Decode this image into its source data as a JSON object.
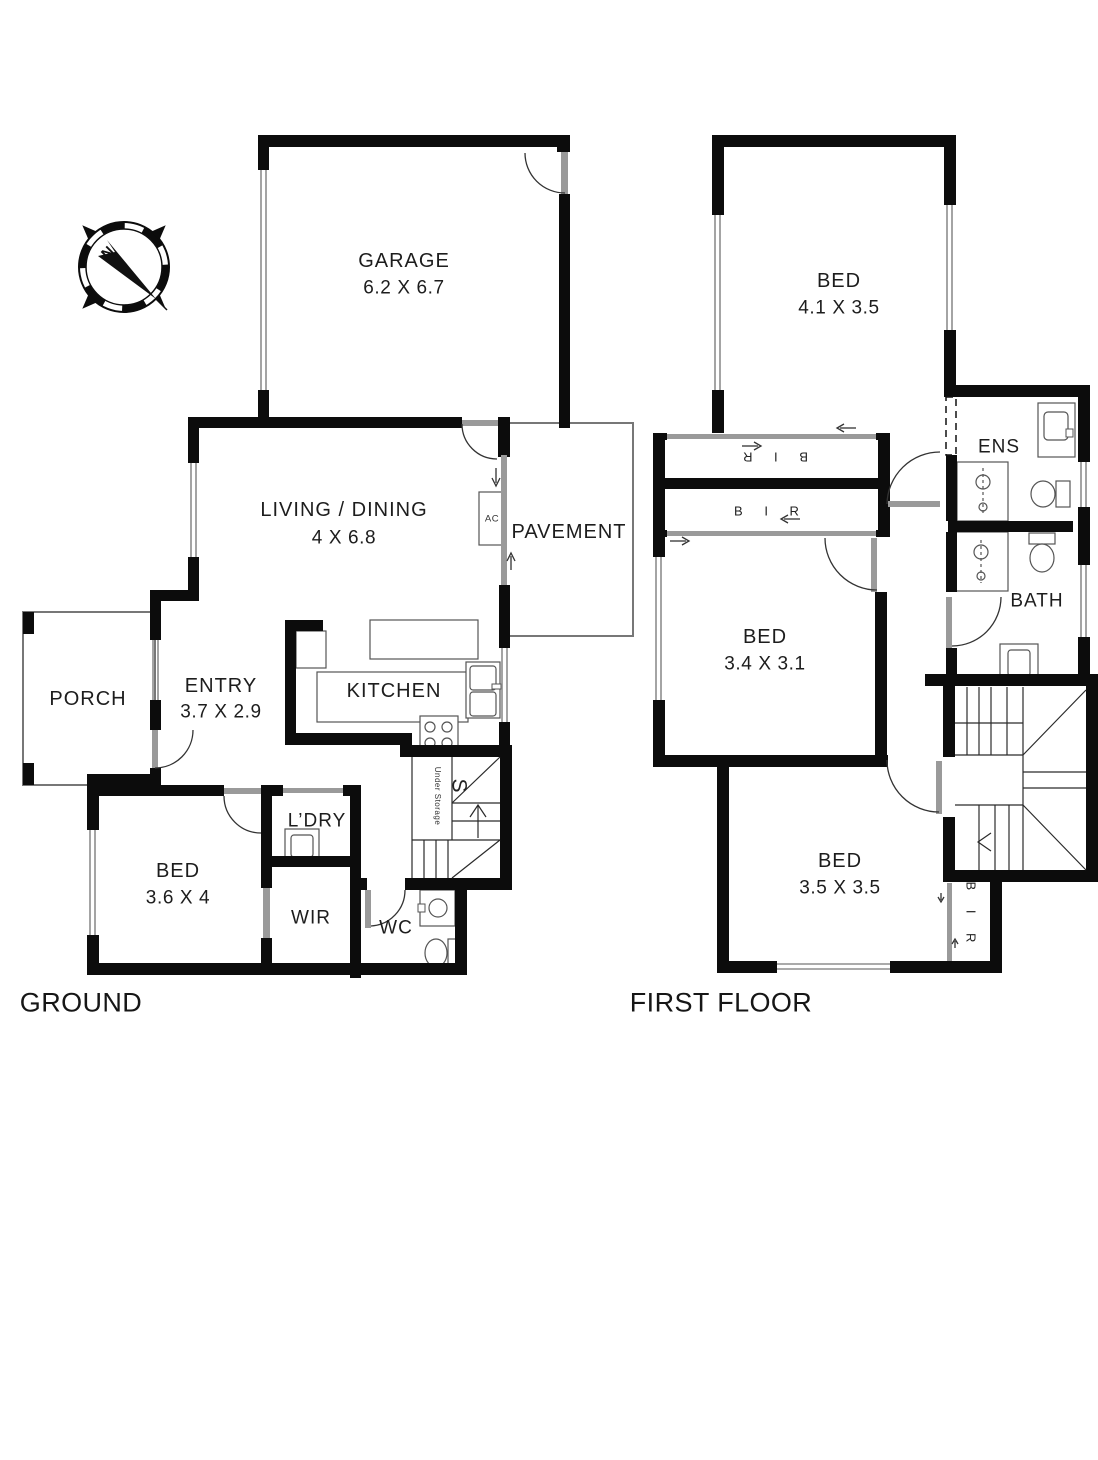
{
  "ground_floor": {
    "caption": "GROUND",
    "garage": {
      "name": "GARAGE",
      "dims": "6.2 X 6.7"
    },
    "living_dining": {
      "name": "LIVING / DINING",
      "dims": "4 X 6.8"
    },
    "pavement": {
      "name": "PAVEMENT"
    },
    "entry": {
      "name": "ENTRY",
      "dims": "3.7 X 2.9"
    },
    "kitchen": {
      "name": "KITCHEN"
    },
    "porch": {
      "name": "PORCH"
    },
    "bed": {
      "name": "BED",
      "dims": "3.6 X 4"
    },
    "laundry": {
      "name": "L’DRY"
    },
    "wir": {
      "name": "WIR"
    },
    "wc": {
      "name": "WC"
    },
    "ac_unit": "AC",
    "stairs": {
      "letter": "S",
      "note": "Under Storage"
    }
  },
  "first_floor": {
    "caption": "FIRST FLOOR",
    "bed_front": {
      "name": "BED",
      "dims": "4.1 X 3.5"
    },
    "ensuite": {
      "name": "ENS"
    },
    "robe_top": {
      "name": "B I R"
    },
    "robe_bottom": {
      "name": "B I R"
    },
    "bed_middle": {
      "name": "BED",
      "dims": "3.4 X 3.1"
    },
    "bathroom": {
      "name": "BATH"
    },
    "bed_rear": {
      "name": "BED",
      "dims": "3.5 X 3.5"
    },
    "robe_side": {
      "name": "B I R"
    }
  },
  "compass": {
    "north": "N"
  },
  "colors": {
    "wall": "#0c0c0c",
    "line": "#555555",
    "window": "#8d8d8d",
    "background": "#ffffff"
  }
}
